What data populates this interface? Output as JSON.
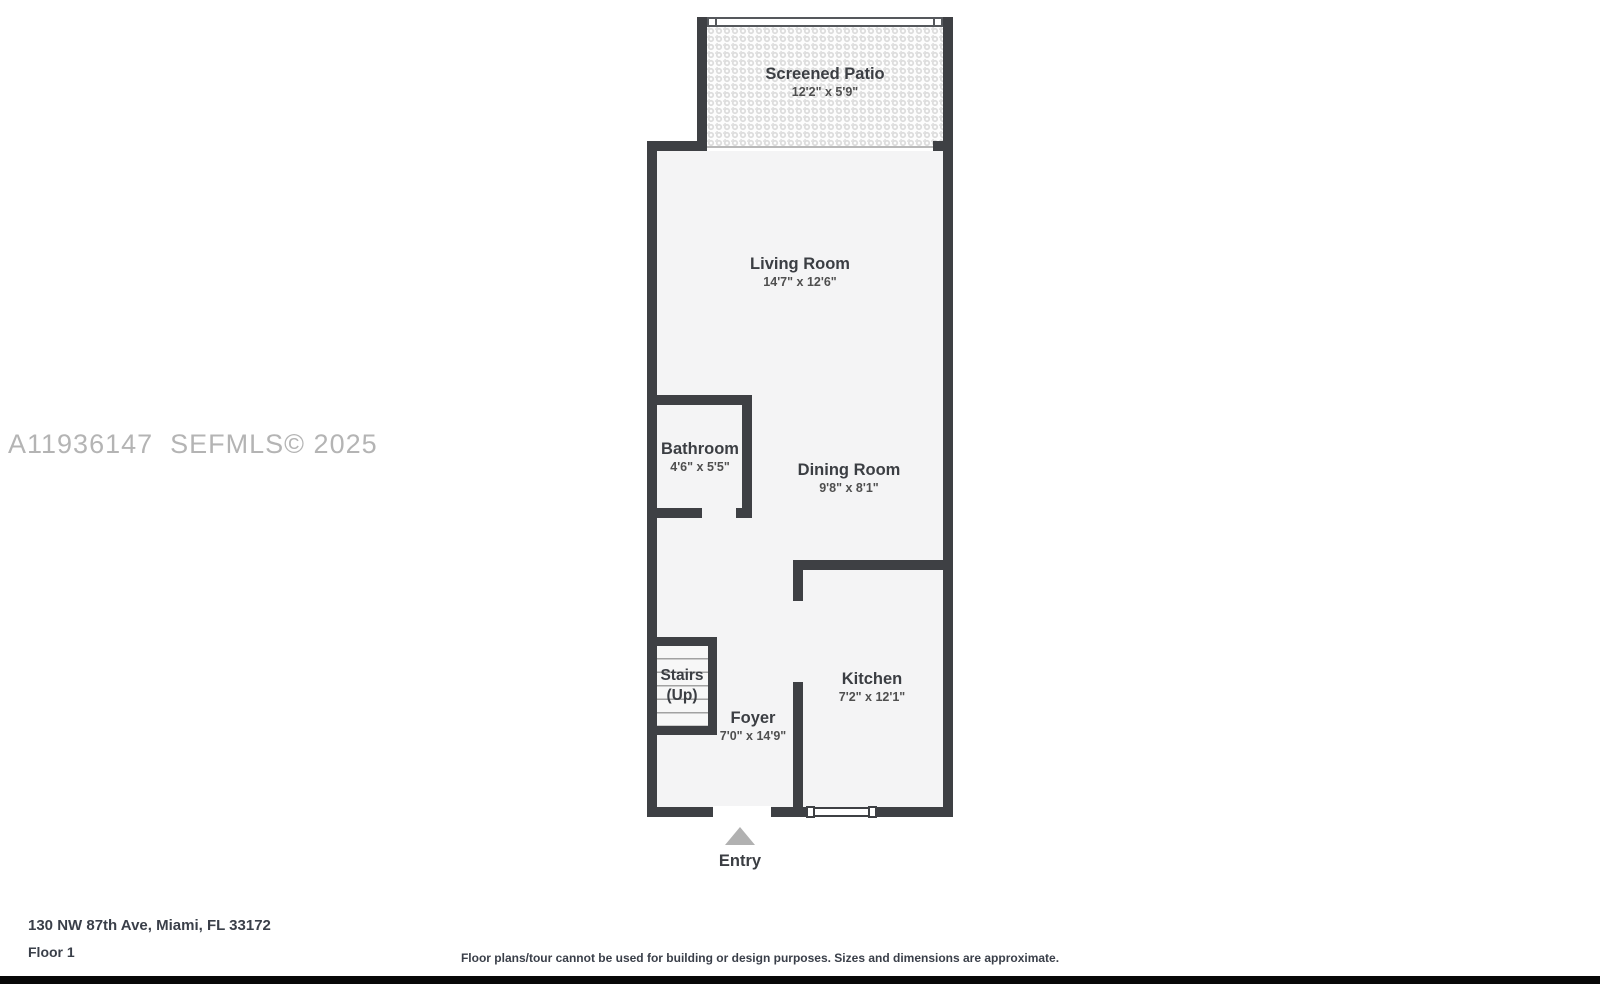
{
  "watermark": "A11936147  SEFMLS© 2025",
  "floor_plan": {
    "rooms": [
      {
        "name": "Screened Patio",
        "dimensions": "12'2\" x 5'9\""
      },
      {
        "name": "Living Room",
        "dimensions": "14'7\" x 12'6\""
      },
      {
        "name": "Bathroom",
        "dimensions": "4'6\" x 5'5\""
      },
      {
        "name": "Dining Room",
        "dimensions": "9'8\" x 8'1\""
      },
      {
        "name": "Stairs",
        "sub": "(Up)"
      },
      {
        "name": "Foyer",
        "dimensions": "7'0\" x 14'9\""
      },
      {
        "name": "Kitchen",
        "dimensions": "7'2\" x 12'1\""
      }
    ],
    "entry_label": "Entry"
  },
  "footer": {
    "address": "130 NW 87th Ave, Miami, FL 33172",
    "floor": "Floor 1",
    "disclaimer": "Floor plans/tour cannot be used for building or design purposes. Sizes and dimensions are approximate."
  },
  "colors": {
    "wall": "#3e4044",
    "floor": "#f4f4f5",
    "patio_texture": "#dcdcdc",
    "entry_arrow": "#b1b1b1",
    "watermark": "#b4b4b4",
    "text": "#3b3e43",
    "footer_bar": "#070707"
  }
}
